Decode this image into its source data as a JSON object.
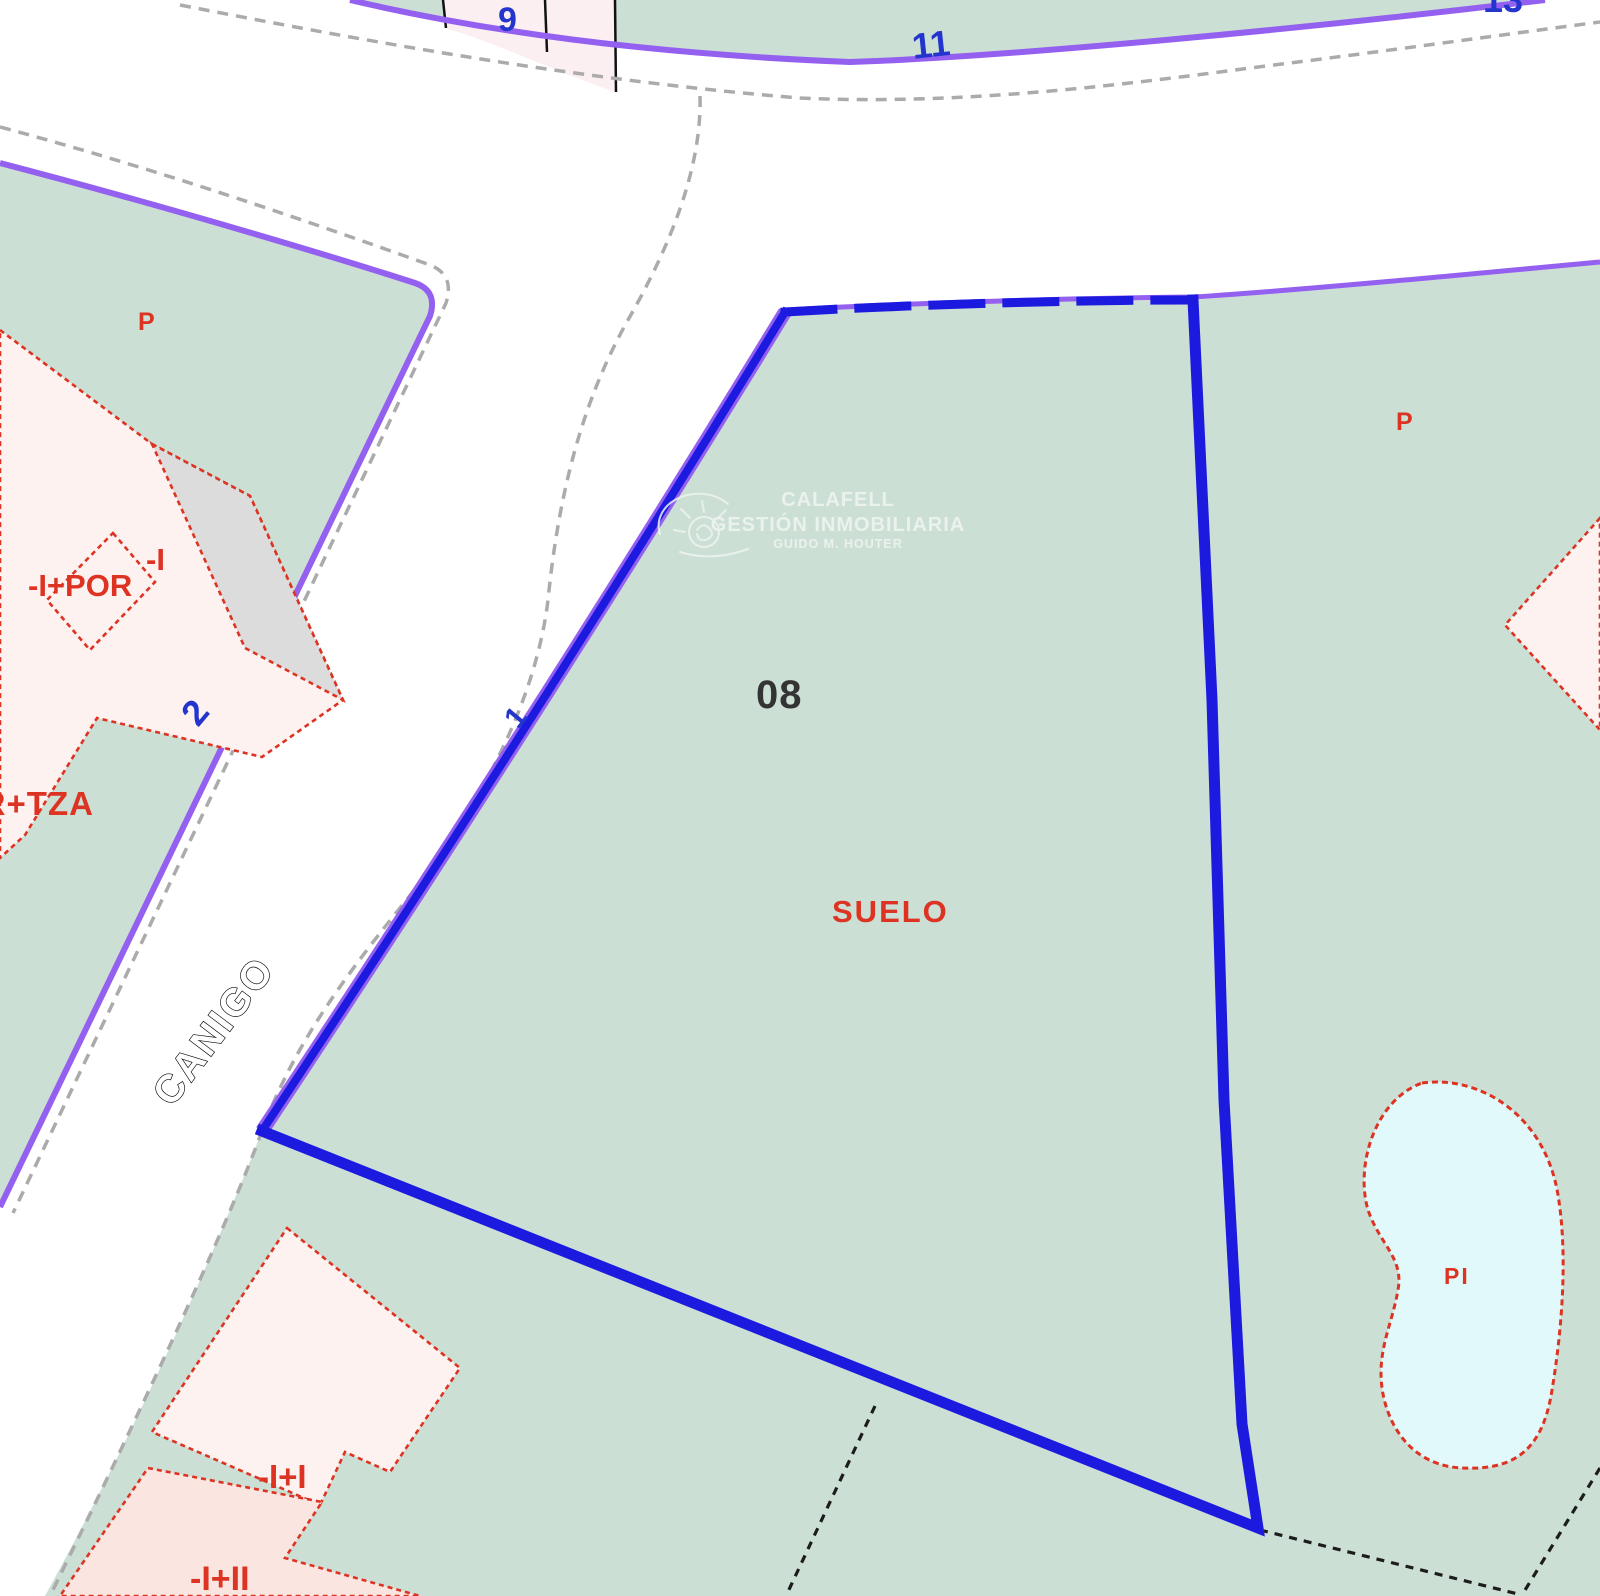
{
  "map": {
    "title": "Cadastral parcel map",
    "watermark": {
      "line1": "CALAFELL",
      "line2": "GESTIÓN INMOBILIARIA",
      "line3": "GUIDO M. HOUTER"
    },
    "labels": {
      "parcel_number_top_left": "9",
      "parcel_number_top": "11",
      "parcel_number_top_right": "13",
      "street_number_left": "2",
      "street_number_center": "1",
      "street_name": "CANIGO",
      "parcel_code": "08",
      "land_use": "SUELO",
      "porch_left": "P",
      "porch_right": "P",
      "pool_label": "PI",
      "building_left_main": "-I+POR",
      "building_left_small": "-I",
      "building_left_edge": "-I",
      "building_left_lower": "POR+TZA",
      "building_bottom_upper": "-I+I",
      "building_bottom_lower": "-I+II"
    },
    "colors": {
      "parcel_green": "#ccdfd5",
      "boundary_purple": "#9460f0",
      "boundary_blue": "#1d1ae0",
      "label_blue": "#2335cc",
      "cadastral_red": "#dd3322",
      "building_pink": "#fdf2f0",
      "building_pink_dark": "#fae5e1",
      "parcel_pink": "#fbeff2",
      "building_gray": "#dcdcdc",
      "pool_cyan": "#e1f9fa",
      "curb_gray": "#ababab",
      "parcel_line_black": "#1c1c1c",
      "watermark_white": "#eef3f0"
    }
  }
}
